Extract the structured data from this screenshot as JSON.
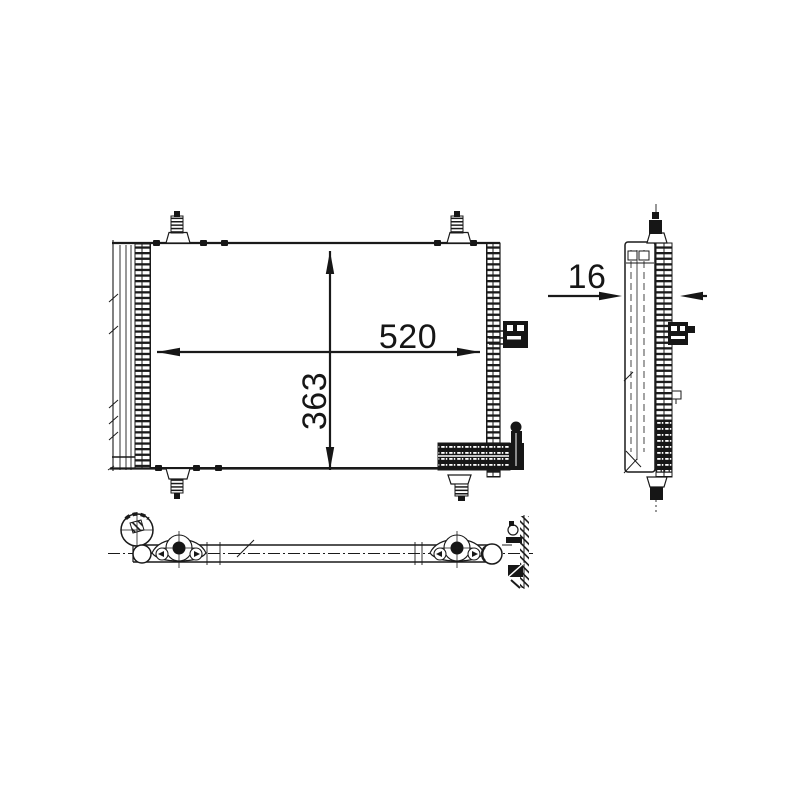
{
  "drawing": {
    "background_color": "#ffffff",
    "line_color": "#1a1a1a",
    "views": {
      "front": {
        "width_dimension": "520",
        "height_dimension": "363"
      },
      "side": {
        "depth_dimension": "16"
      }
    }
  }
}
